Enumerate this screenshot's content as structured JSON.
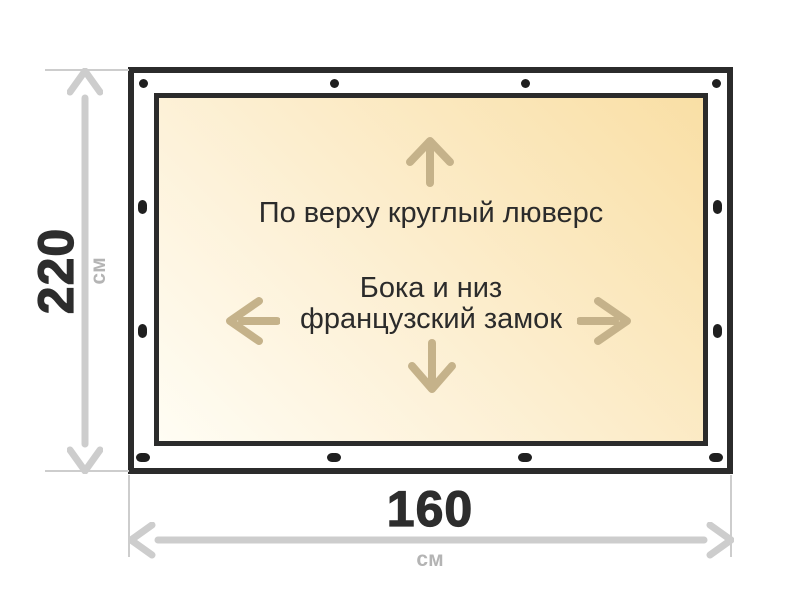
{
  "dimensions": {
    "height": {
      "value": "220",
      "unit": "см"
    },
    "width": {
      "value": "160",
      "unit": "см"
    }
  },
  "annotations": {
    "top": "По верху круглый люверс",
    "sides_line1": "Бока и низ",
    "sides_line2": "французский замок"
  },
  "fasteners": {
    "top_round_grommets": 4,
    "bottom_slots": 4,
    "left_slots": 2,
    "right_slots": 2
  },
  "icons": {
    "arrow-up-icon": "direction arrow up (top edge)",
    "arrow-down-icon": "direction arrow down (bottom edge)",
    "arrow-left-icon": "direction arrow left (side edge)",
    "arrow-right-icon": "direction arrow right (side edge)",
    "dimension-arrow-vertical-icon": "double-headed height dimension arrow",
    "dimension-arrow-horizontal-icon": "double-headed width dimension arrow",
    "grommet-dot-icon": "round grommet mark",
    "lock-slot-icon": "oval lock slot mark"
  },
  "colors": {
    "outline": "#2B2B2B",
    "fabric_light": "#FFFDF4",
    "fabric_dark": "#F9DFA5",
    "direction_arrow": "#C5B28A",
    "dimension_line": "#CDCDCD",
    "dimension_value_text": "#2D2D2D",
    "dimension_unit_text": "#B4B4B4",
    "fastener": "#1F1F1F"
  }
}
